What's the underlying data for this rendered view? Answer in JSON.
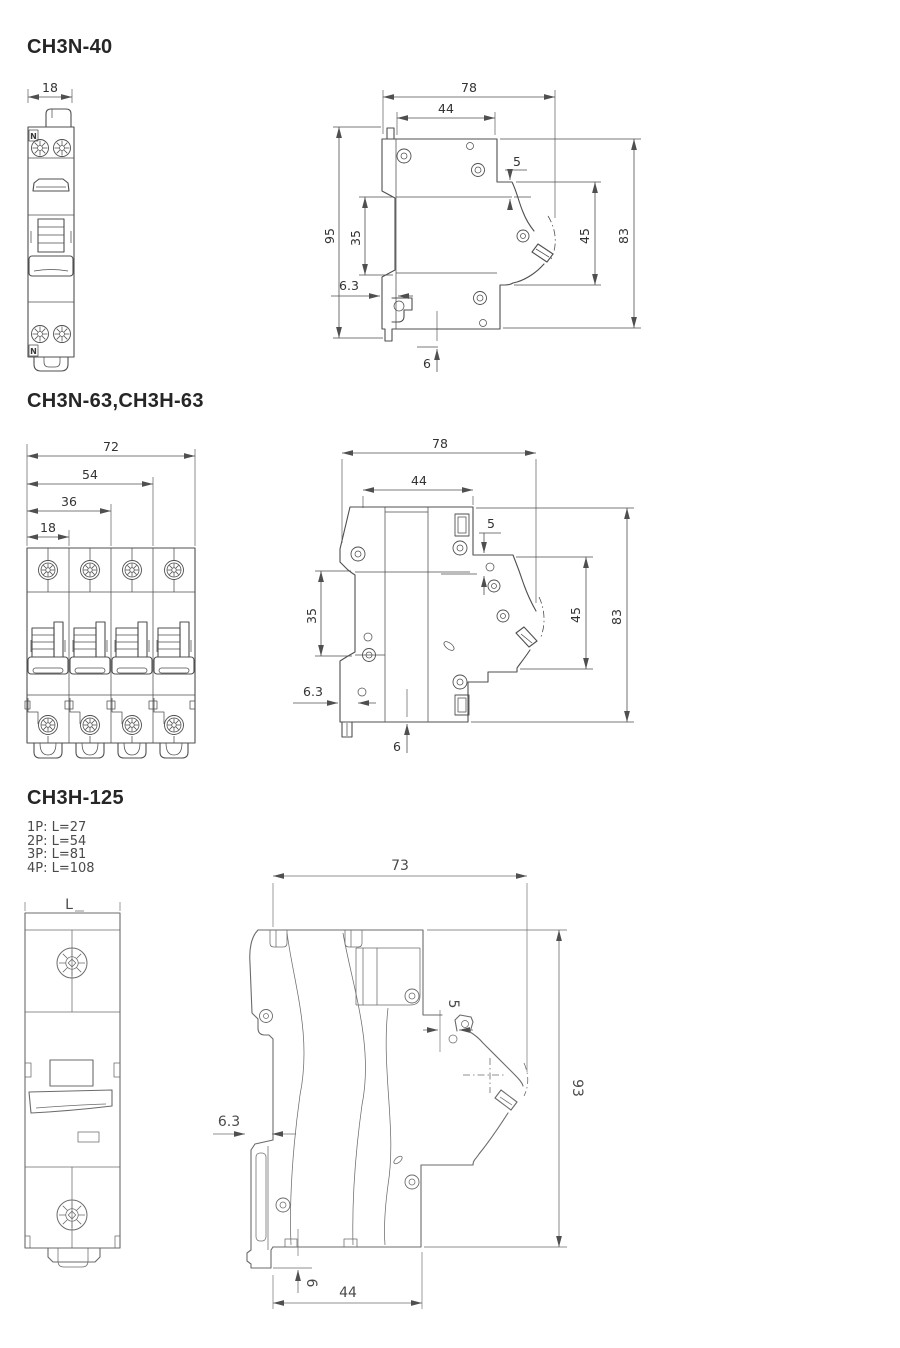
{
  "page": {
    "background": "#ffffff",
    "line_color": "#4f4f4f",
    "line_color_light": "#6b6b6b",
    "text_color": "#333333"
  },
  "s1": {
    "title": "CH3N-40",
    "front": {
      "w18": "18",
      "n_top": "N",
      "n_bottom": "N"
    },
    "side": {
      "w78": "78",
      "w44": "44",
      "g5": "5",
      "h95": "95",
      "h35": "35",
      "h45": "45",
      "h83": "83",
      "g63": "6.3",
      "g6": "6"
    }
  },
  "s2": {
    "title": "CH3N-63,CH3H-63",
    "front": {
      "w72": "72",
      "w54": "54",
      "w36": "36",
      "w18": "18"
    },
    "side": {
      "w78": "78",
      "w44": "44",
      "g5": "5",
      "h35": "35",
      "h45": "45",
      "h83": "83",
      "g63": "6.3",
      "g6": "6"
    }
  },
  "s3": {
    "title": "CH3H-125",
    "notes": [
      "1P: L=27",
      "2P: L=54",
      "3P: L=81",
      "4P: L=108"
    ],
    "front": {
      "wL": "L"
    },
    "side": {
      "w73": "73",
      "g5": "5",
      "h93": "93",
      "g63": "6.3",
      "g6": "6",
      "w44": "44"
    }
  }
}
